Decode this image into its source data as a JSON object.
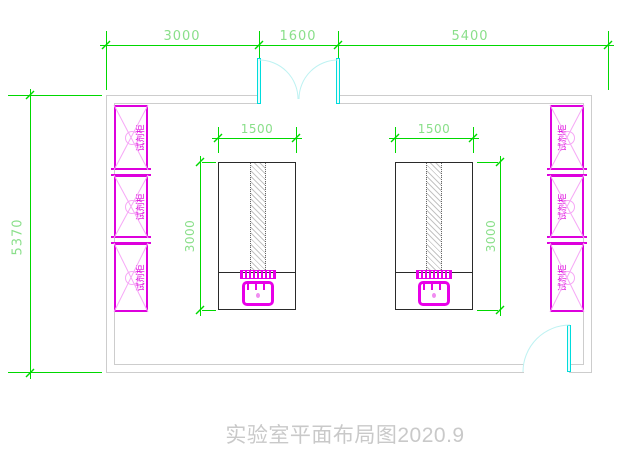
{
  "drawing": {
    "title": "实验室平面布局图2020.9"
  },
  "dimensions": {
    "top_row": [
      {
        "name": "left-bay-width",
        "label": "3000"
      },
      {
        "name": "door-opening-width",
        "label": "1600"
      },
      {
        "name": "right-bay-width",
        "label": "5400"
      }
    ],
    "room_height": {
      "label": "5370"
    },
    "left_bench": {
      "width": "1500",
      "depth": "3000"
    },
    "right_bench": {
      "width": "1500",
      "depth": "3000"
    }
  },
  "cabinets": {
    "label": "试剂柜",
    "left_column_units": 3,
    "right_column_units": 3
  },
  "colors": {
    "dimension_green": "#00d800",
    "dimension_text_green": "#8adf8a",
    "wall_gray": "#cdcdcd",
    "door_cyan": "#00dcdc",
    "door_arc_cyan": "#bdf2f2",
    "cabinet_magenta": "#dd00dd",
    "cabinet_detail_pink": "#f6a8f6",
    "bench_outline": "#2a2a2a",
    "sink_magenta": "#e800e8",
    "title_gray": "#c9c9c9"
  }
}
